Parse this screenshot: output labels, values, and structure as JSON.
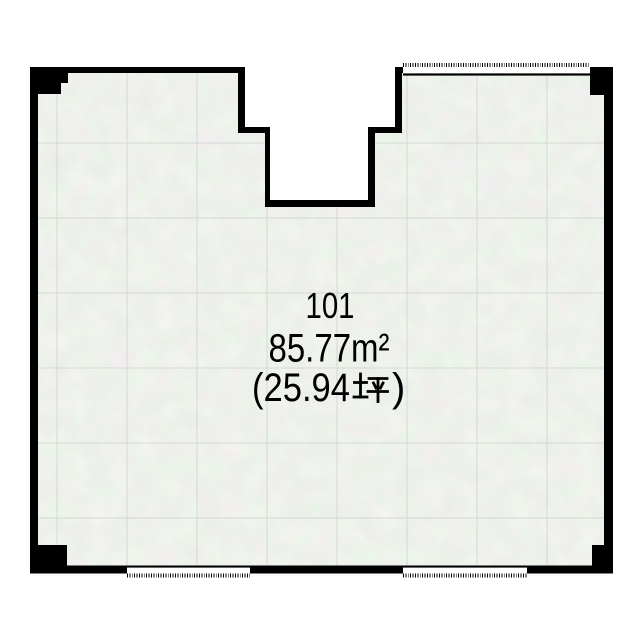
{
  "room": {
    "number": "101",
    "area_sqm": "85.77m²",
    "area_tsubo": "(25.94坪)",
    "area_tsubo_prefix": "(25.94",
    "area_tsubo_unit": "坪",
    "area_tsubo_suffix": ")"
  },
  "colors": {
    "wall": "#000000",
    "floor": "#e7eae5",
    "grid_line": "#a9b2a8",
    "background": "#ffffff",
    "text": "#000000"
  },
  "floorplan": {
    "shape": "rectangular room with stepped entry notch at top center",
    "windows": [
      {
        "side": "top-right",
        "style": "white gap with tick marks"
      },
      {
        "side": "bottom-left",
        "style": "white gap with tick marks"
      },
      {
        "side": "bottom-right",
        "style": "white gap with tick marks"
      }
    ],
    "pillars": [
      "top-left",
      "top-right",
      "bottom-left",
      "bottom-right"
    ]
  }
}
